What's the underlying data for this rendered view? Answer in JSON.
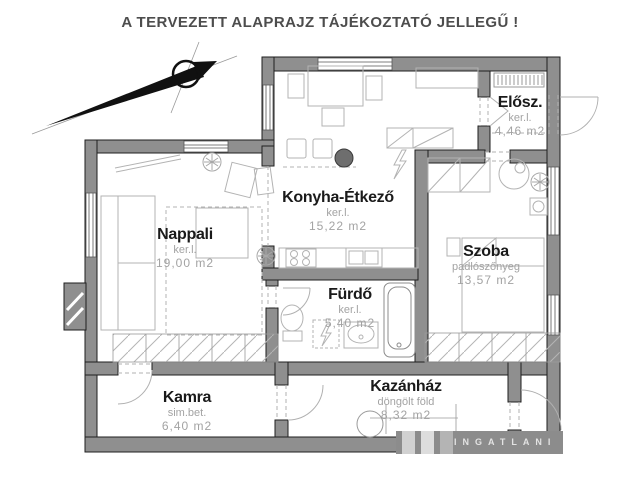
{
  "title": "A TERVEZETT ALAPRAJZ TÁJÉKOZTATÓ JELLEGŰ !",
  "rooms": {
    "nappali": {
      "name": "Nappali",
      "material": "ker.l.",
      "area": "19,00 m2"
    },
    "konyha": {
      "name": "Konyha-Étkező",
      "material": "ker.l.",
      "area": "15,22 m2"
    },
    "elosz": {
      "name": "Elősz.",
      "material": "ker.l.",
      "area": "4,46 m2"
    },
    "szoba": {
      "name": "Szoba",
      "material": "padlószőnyeg",
      "area": "13,57 m2"
    },
    "furdo": {
      "name": "Fürdő",
      "material": "ker.l.",
      "area": "5,40 m2"
    },
    "kamra": {
      "name": "Kamra",
      "material": "sim.bet.",
      "area": "6,40 m2"
    },
    "kazanhaz": {
      "name": "Kazánház",
      "material": "döngölt föld",
      "area": "8,32 m2"
    }
  },
  "watermark": {
    "text": "INGATLANI"
  },
  "colors": {
    "wall": "#8f8f8f",
    "furniture": "#b3b3b3",
    "muted_text": "#a3a3a3",
    "title_text": "#4d4d4d"
  }
}
